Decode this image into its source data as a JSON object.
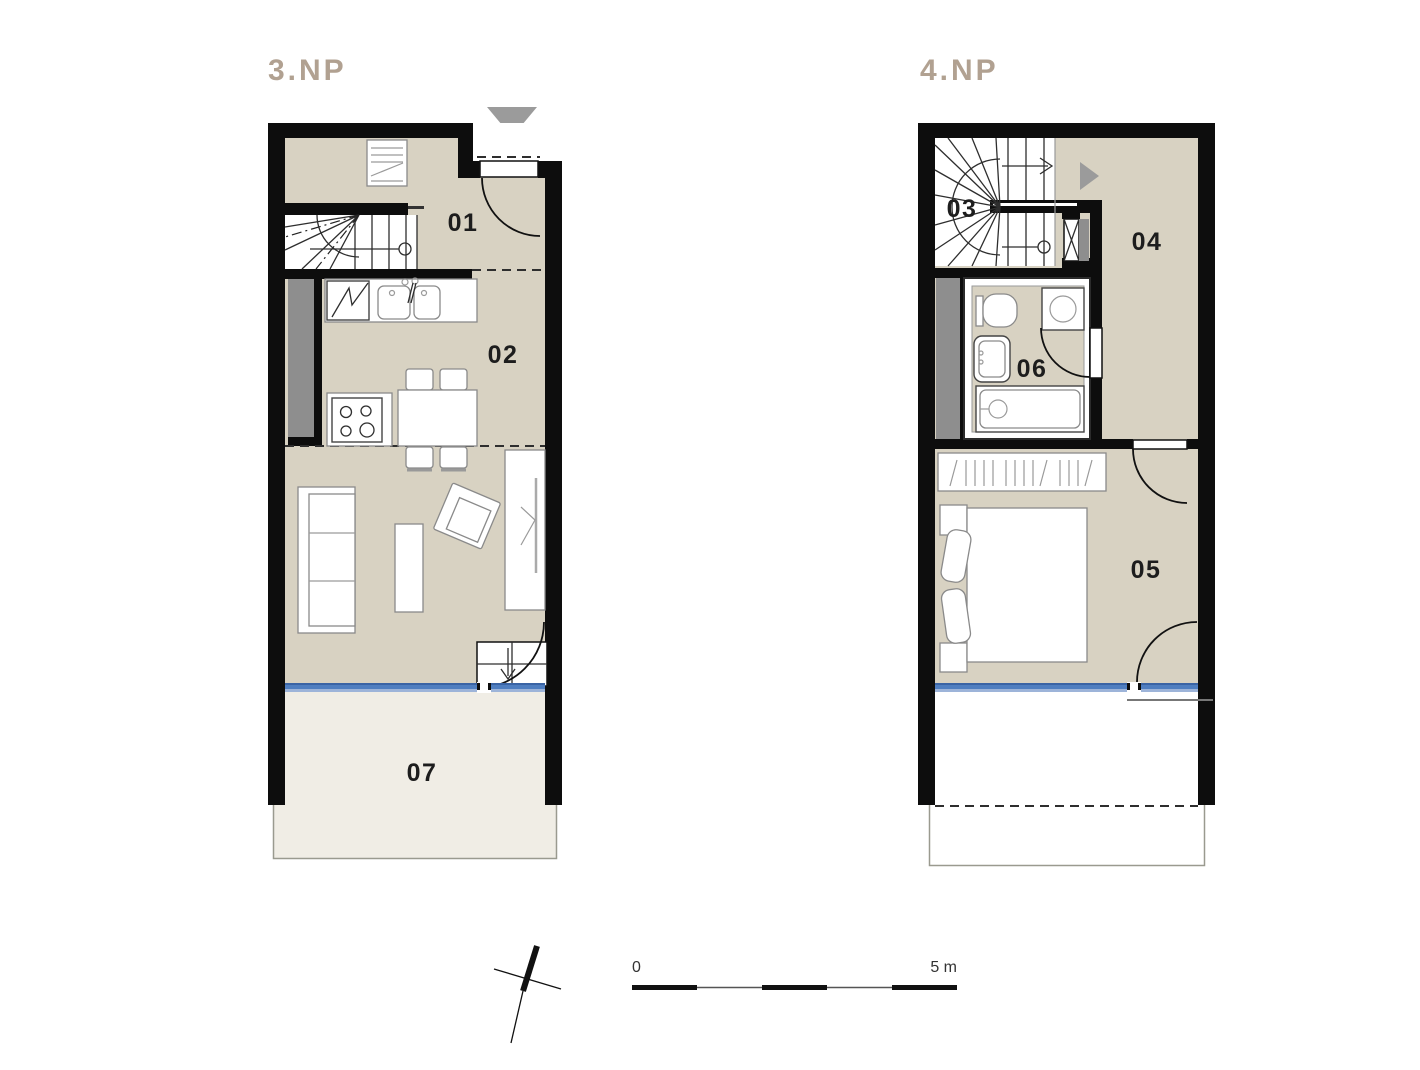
{
  "document": {
    "type": "apartment-floor-plan",
    "background": "#ffffff"
  },
  "plans": [
    {
      "id": "3np",
      "title": "3.NP",
      "rooms": [
        {
          "number": "01"
        },
        {
          "number": "02"
        },
        {
          "number": "07"
        }
      ]
    },
    {
      "id": "4np",
      "title": "4.NP",
      "rooms": [
        {
          "number": "03"
        },
        {
          "number": "04"
        },
        {
          "number": "05"
        },
        {
          "number": "06"
        }
      ]
    }
  ],
  "scale_bar": {
    "start_label": "0",
    "end_label": "5 m"
  },
  "icons": [
    "entrance-arrow-down-icon",
    "entrance-arrow-right-icon",
    "north-compass-icon",
    "stair-direction-arrow-icon",
    "stair-down-arrow-icon"
  ],
  "colors": {
    "wall": "#0d0d0d",
    "floor_fill": "#d8d2c2",
    "terrace_fill": "#f0ede5",
    "shaft_gray": "#8e8e8e",
    "entry_arrow_gray": "#9b9b9b",
    "glazing_blue": "#4f7ec0",
    "glazing_blue_dark": "#3a64a5",
    "glazing_blue_light": "#9db4d9",
    "title_taupe": "#b1a191",
    "label_black": "#1d1d1d",
    "furniture_outline": "#8a8a8a",
    "balcony_outline": "#9a9a8f"
  }
}
